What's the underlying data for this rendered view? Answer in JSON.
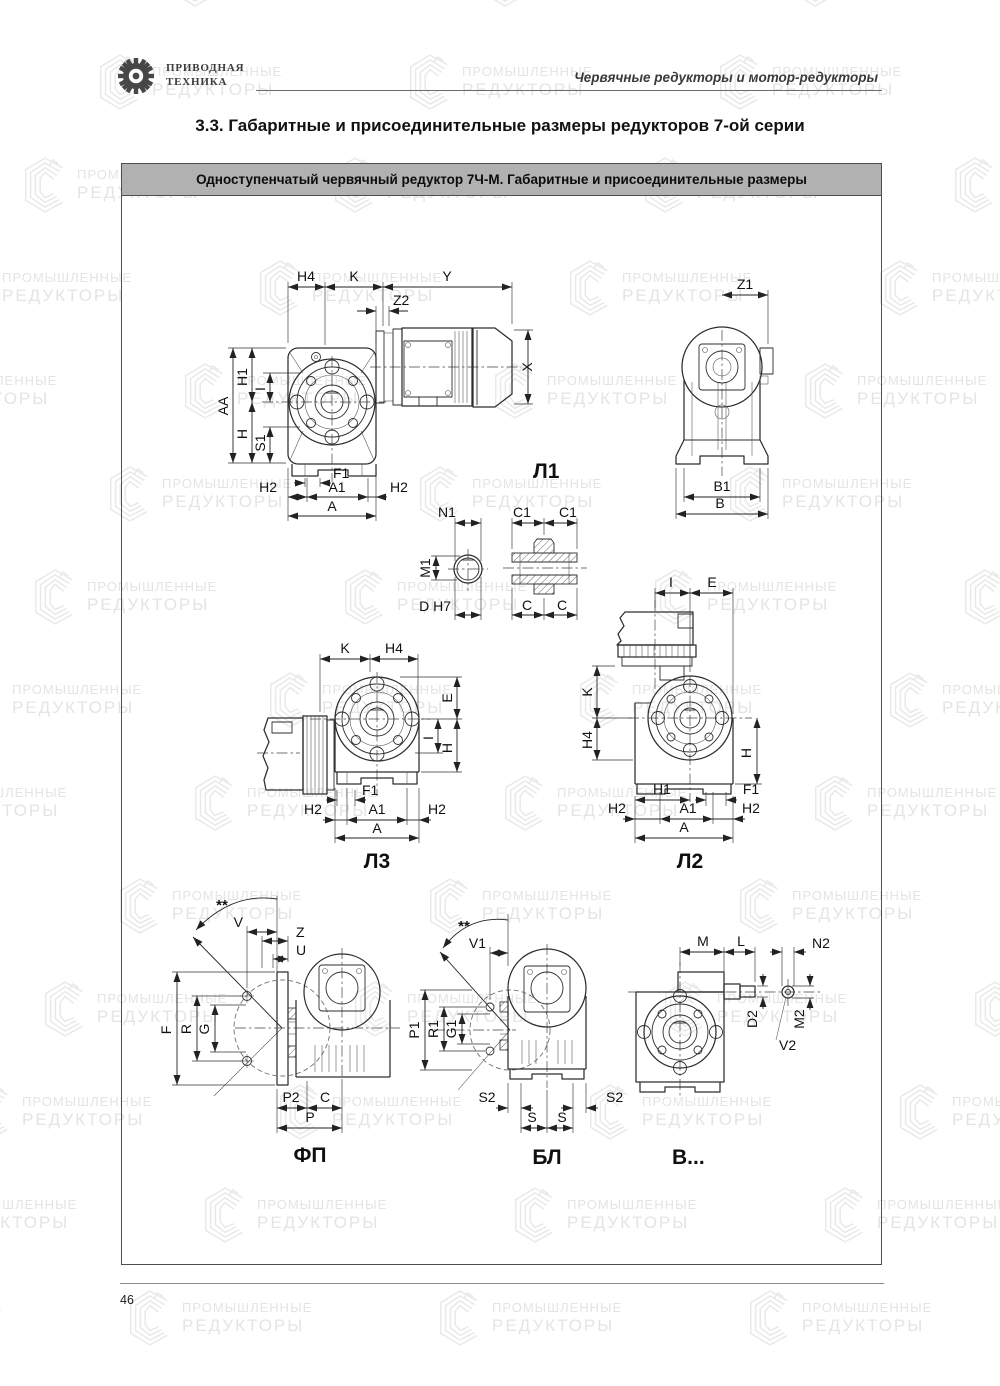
{
  "header": {
    "logo": {
      "line1": "ПРИВОДНАЯ",
      "line2": "ТЕХНИКА"
    },
    "right_text": "Червячные редукторы и мотор-редукторы"
  },
  "title": "3.3. Габаритные и присоединительные размеры редукторов 7-ой серии",
  "panel": {
    "header": "Одноступенчатый червячный редуктор 7Ч-М. Габаритные и присоединительные размеры"
  },
  "watermark": {
    "line1": "ПРОМЫШЛЕННЫЕ",
    "line2": "РЕДУКТОРЫ"
  },
  "footer": {
    "page_number": "46"
  },
  "drawings": {
    "l1": {
      "label": "Л1",
      "dims": {
        "h4": "H4",
        "k": "K",
        "y": "Y",
        "z2": "Z2",
        "x": "X",
        "aa": "AA",
        "h1": "H1",
        "i": "I",
        "h": "H",
        "s1": "S1",
        "f1": "F1",
        "h2": "H2",
        "a1": "A1",
        "a": "A"
      }
    },
    "rear": {
      "dims": {
        "z1": "Z1",
        "b1": "B1",
        "b": "B"
      }
    },
    "shaft_end": {
      "dims": {
        "n1": "N1",
        "m1": "M1",
        "d": "D H7"
      }
    },
    "bushing": {
      "dims": {
        "c1": "C1",
        "c": "C"
      }
    },
    "l3": {
      "label": "Л3",
      "dims": {
        "k": "K",
        "h4": "H4",
        "e": "E",
        "i": "I",
        "h": "H",
        "f1": "F1",
        "h2": "H2",
        "a1": "A1",
        "a": "A"
      }
    },
    "l2": {
      "label": "Л2",
      "dims": {
        "i": "I",
        "e": "E",
        "k": "K",
        "h4": "H4",
        "h": "H",
        "h1": "H1",
        "f1": "F1",
        "h2": "H2",
        "a1": "A1",
        "a": "A"
      }
    },
    "fp": {
      "label": "ФП",
      "dims": {
        "angle": "**",
        "v": "V",
        "z": "Z",
        "u": "U",
        "f": "F",
        "r": "R",
        "g": "G",
        "p2": "P2",
        "c": "C",
        "p": "P"
      }
    },
    "bl": {
      "label": "БЛ",
      "dims": {
        "angle": "**",
        "v1": "V1",
        "p1": "P1",
        "r1": "R1",
        "g1": "G1",
        "s2": "S2",
        "s": "S"
      }
    },
    "vv": {
      "label": "В...",
      "dims": {
        "m": "M",
        "l": "L",
        "n2": "N2",
        "d2": "D2",
        "m2": "M2",
        "v2": "V2"
      }
    }
  }
}
